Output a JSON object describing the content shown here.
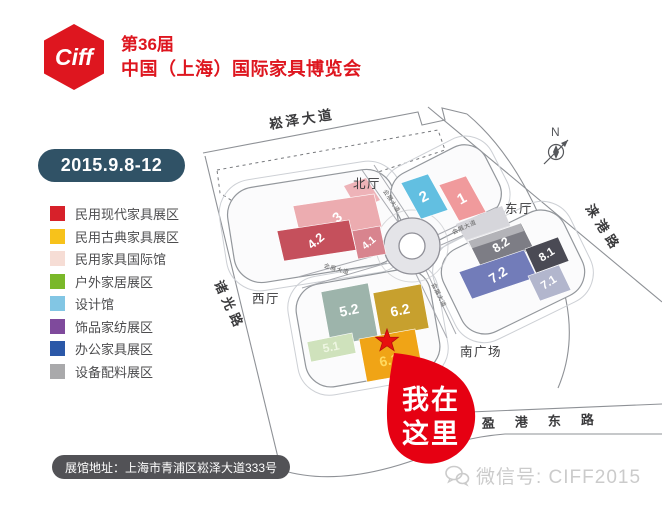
{
  "header": {
    "logo_text": "Ciff",
    "edition": "第36届",
    "title": "中国（上海）国际家具博览会"
  },
  "date_badge": "2015.9.8-12",
  "legend": {
    "items": [
      {
        "label": "民用现代家具展区",
        "color": "#d7212a"
      },
      {
        "label": "民用古典家具展区",
        "color": "#f7c21b"
      },
      {
        "label": "民用家具国际馆",
        "color": "#f6ddd5"
      },
      {
        "label": "户外家居展区",
        "color": "#7ab829"
      },
      {
        "label": "设计馆",
        "color": "#82c6e4"
      },
      {
        "label": "饰品家纺展区",
        "color": "#7f4a9c"
      },
      {
        "label": "办公家具展区",
        "color": "#2b58a8"
      },
      {
        "label": "设备配料展区",
        "color": "#a9a9ab"
      }
    ]
  },
  "map": {
    "compass": "N",
    "roads": {
      "north": "崧泽大道",
      "west": "诸光路",
      "east": "涞港路",
      "south": "盈港东路",
      "internal": "会展大道"
    },
    "areas": {
      "north_hall": "北厅",
      "east_hall": "东厅",
      "west_hall": "西厅",
      "south_plaza": "南广场"
    },
    "halls": [
      {
        "id": "3",
        "label": "3",
        "color": "#ecacb0",
        "label_color": "#ffffff"
      },
      {
        "id": "4.2",
        "label": "4.2",
        "color": "#c5505c",
        "label_color": "#ffffff"
      },
      {
        "id": "4.1",
        "label": "4.1",
        "color": "#d8848e",
        "label_color": "#ffffff"
      },
      {
        "id": "2",
        "label": "2",
        "color": "#62bfe1",
        "label_color": "#ffffff"
      },
      {
        "id": "1",
        "label": "1",
        "color": "#f09a9c",
        "label_color": "#ffffff"
      },
      {
        "id": "8.2",
        "label": "8.2",
        "color": "#7d7d85",
        "label_color": "#ffffff"
      },
      {
        "id": "8.1",
        "label": "8.1",
        "color": "#4a4a54",
        "label_color": "#ffffff"
      },
      {
        "id": "7.2",
        "label": "7.2",
        "color": "#727cb9",
        "label_color": "#ffffff"
      },
      {
        "id": "7.1",
        "label": "7.1",
        "color": "#b2b6cd",
        "label_color": "#ffffff"
      },
      {
        "id": "5.2",
        "label": "5.2",
        "color": "#9db4ab",
        "label_color": "#ffffff"
      },
      {
        "id": "5.1",
        "label": "5.1",
        "color": "#cfe2bc",
        "label_color": "#eef6e2"
      },
      {
        "id": "6.2",
        "label": "6.2",
        "color": "#c7a02e",
        "label_color": "#ffffff"
      },
      {
        "id": "6.1",
        "label": "6.1",
        "color": "#f0a416",
        "label_color": "#ffd95e"
      }
    ],
    "marker": {
      "line1": "我在",
      "line2": "这里",
      "color": "#e60012",
      "star_color": "#e8110e"
    }
  },
  "footer": {
    "address": "展馆地址：上海市青浦区崧泽大道333号",
    "wechat": "微信号: CIFF2015"
  }
}
